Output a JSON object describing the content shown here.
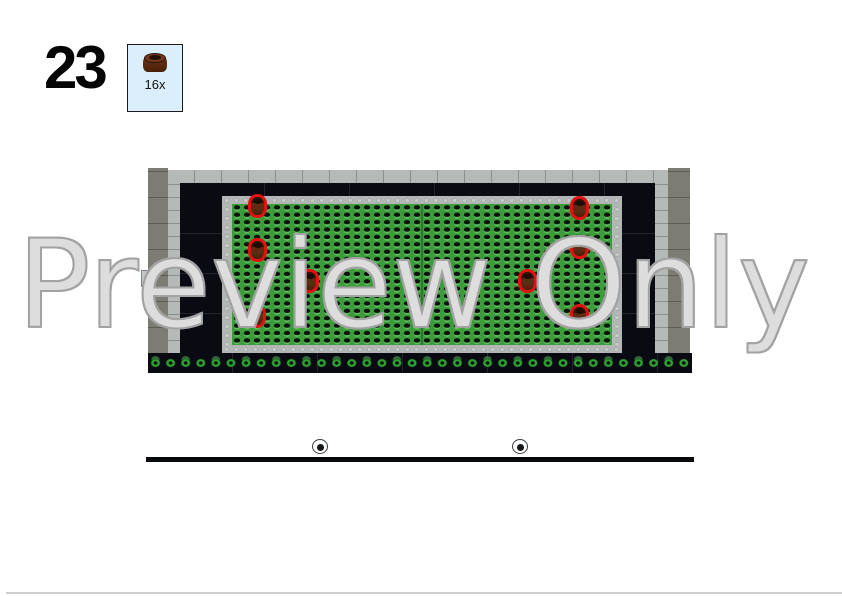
{
  "step": {
    "number": "23"
  },
  "parts_callout": {
    "count": "16x",
    "part": "dark-brown-round-plate-1x1"
  },
  "watermark": {
    "text": "Preview Only"
  },
  "build": {
    "scene": "top-down LEGO render: gray walled courtyard, black inner band, green studded lawn, plant hedge row, sidewalk and black road with two manhole/wheel discs",
    "highlighted_parts": {
      "part": "dark-brown-round-plate-1x1",
      "positions": [
        [
          112,
          68
        ],
        [
          112,
          112
        ],
        [
          111,
          178
        ],
        [
          164,
          143
        ],
        [
          434,
          70
        ],
        [
          434,
          109
        ],
        [
          382,
          143
        ],
        [
          434,
          178
        ]
      ]
    },
    "wheels": {
      "positions": [
        [
          172,
          306
        ],
        [
          372,
          306
        ]
      ]
    }
  },
  "colors": {
    "box_fill": "#daeefb",
    "wall_dark": "#7c7c74",
    "wall_light": "#b5b9b8",
    "band_black": "#0a0a13",
    "stud_border": "#b2b6b5",
    "lawn": "#3c9c3c",
    "plant": "#2f9e33",
    "pave": "#a9adac",
    "stripe": "#3ab43a",
    "road": "#0d1117",
    "brown": "#5c2c13",
    "highlight": "#e11111",
    "divider": "#cfcfcf"
  }
}
